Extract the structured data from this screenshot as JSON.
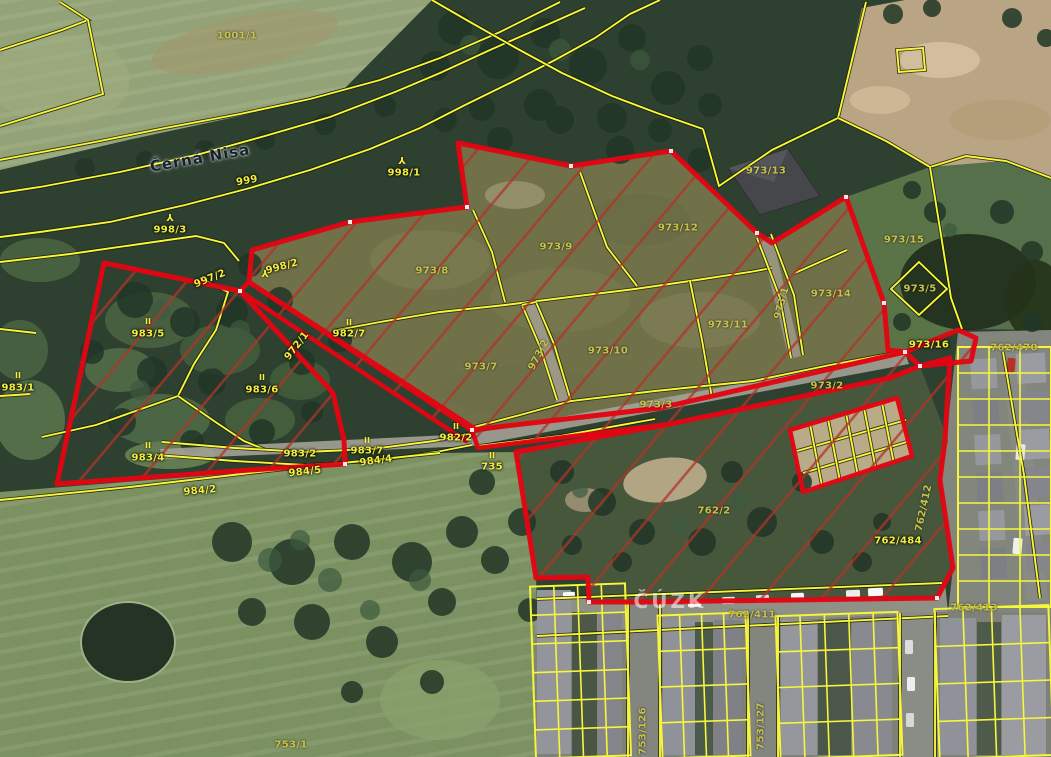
{
  "map": {
    "colors": {
      "parcel_line": "#f6f63c",
      "selection_outline": "#e30613",
      "hatch_fill": "#b23428"
    },
    "labels": [
      {
        "text": "1001/1",
        "x": 237,
        "y": 36,
        "kind": "muted"
      },
      {
        "text": "Černá Nisa",
        "x": 200,
        "y": 158,
        "rot": -10,
        "kind": "river"
      },
      {
        "text": "999",
        "x": 247,
        "y": 181,
        "rot": -10
      },
      {
        "text": "998/1",
        "x": 404,
        "y": 173
      },
      {
        "text": "998/3",
        "x": 170,
        "y": 230
      },
      {
        "text": "997/2",
        "x": 210,
        "y": 279,
        "rot": -22
      },
      {
        "text": "998/2",
        "x": 282,
        "y": 267,
        "rot": -15
      },
      {
        "text": "972/1",
        "x": 297,
        "y": 346,
        "rot": -52
      },
      {
        "text": "982/7",
        "x": 349,
        "y": 334
      },
      {
        "text": "983/5",
        "x": 148,
        "y": 334
      },
      {
        "text": "983/6",
        "x": 262,
        "y": 390
      },
      {
        "text": "983/4",
        "x": 148,
        "y": 458
      },
      {
        "text": "983/2",
        "x": 300,
        "y": 454
      },
      {
        "text": "983/7",
        "x": 367,
        "y": 451
      },
      {
        "text": "984/4",
        "x": 376,
        "y": 461,
        "rot": -8
      },
      {
        "text": "984/5",
        "x": 305,
        "y": 472,
        "rot": -6
      },
      {
        "text": "984/2",
        "x": 200,
        "y": 491,
        "rot": -5
      },
      {
        "text": "983/1",
        "x": 18,
        "y": 388
      },
      {
        "text": "735",
        "x": 492,
        "y": 467
      },
      {
        "text": "982/2",
        "x": 456,
        "y": 438
      },
      {
        "text": "973/8",
        "x": 432,
        "y": 271,
        "kind": "muted"
      },
      {
        "text": "973/9",
        "x": 556,
        "y": 247,
        "kind": "muted"
      },
      {
        "text": "973/12",
        "x": 678,
        "y": 228,
        "kind": "muted"
      },
      {
        "text": "973/13",
        "x": 766,
        "y": 171,
        "kind": "muted"
      },
      {
        "text": "973/15",
        "x": 904,
        "y": 240,
        "kind": "muted"
      },
      {
        "text": "973/5",
        "x": 920,
        "y": 289,
        "kind": "muted"
      },
      {
        "text": "973/14",
        "x": 831,
        "y": 294,
        "kind": "muted"
      },
      {
        "text": "973/11",
        "x": 728,
        "y": 325,
        "kind": "muted"
      },
      {
        "text": "973/10",
        "x": 608,
        "y": 351,
        "kind": "muted"
      },
      {
        "text": "973/7",
        "x": 481,
        "y": 367,
        "kind": "muted"
      },
      {
        "text": "973/2",
        "x": 539,
        "y": 355,
        "rot": -62,
        "kind": "muted"
      },
      {
        "text": "973/1",
        "x": 782,
        "y": 303,
        "rot": -75,
        "kind": "muted"
      },
      {
        "text": "973/3",
        "x": 656,
        "y": 405,
        "kind": "muted"
      },
      {
        "text": "973/2",
        "x": 827,
        "y": 386,
        "kind": "muted"
      },
      {
        "text": "973/16",
        "x": 929,
        "y": 345
      },
      {
        "text": "762/470",
        "x": 1014,
        "y": 348,
        "kind": "muted"
      },
      {
        "text": "762/2",
        "x": 714,
        "y": 511,
        "kind": "muted"
      },
      {
        "text": "762/484",
        "x": 898,
        "y": 541
      },
      {
        "text": "762/412",
        "x": 924,
        "y": 508,
        "rot": -78,
        "kind": "muted"
      },
      {
        "text": "762/411",
        "x": 752,
        "y": 615,
        "kind": "muted"
      },
      {
        "text": "762/413",
        "x": 974,
        "y": 608,
        "kind": "muted"
      },
      {
        "text": "753/1",
        "x": 291,
        "y": 745,
        "kind": "muted"
      },
      {
        "text": "753/126",
        "x": 643,
        "y": 731,
        "rot": -90,
        "kind": "muted"
      },
      {
        "text": "753/127",
        "x": 761,
        "y": 726,
        "rot": -90,
        "kind": "muted"
      },
      {
        "text": "ČÚZK",
        "x": 670,
        "y": 601,
        "kind": "watermark"
      }
    ],
    "symbols": [
      {
        "type": "tree",
        "x": 402,
        "y": 159
      },
      {
        "type": "tree",
        "x": 170,
        "y": 216
      },
      {
        "type": "tree",
        "x": 265,
        "y": 272
      },
      {
        "type": "meadow",
        "x": 148,
        "y": 322
      },
      {
        "type": "meadow",
        "x": 262,
        "y": 378
      },
      {
        "type": "meadow",
        "x": 148,
        "y": 446
      },
      {
        "type": "meadow",
        "x": 349,
        "y": 323
      },
      {
        "type": "meadow",
        "x": 456,
        "y": 427
      },
      {
        "type": "meadow",
        "x": 492,
        "y": 456
      },
      {
        "type": "meadow",
        "x": 367,
        "y": 441
      },
      {
        "type": "meadow",
        "x": 18,
        "y": 376
      }
    ]
  }
}
